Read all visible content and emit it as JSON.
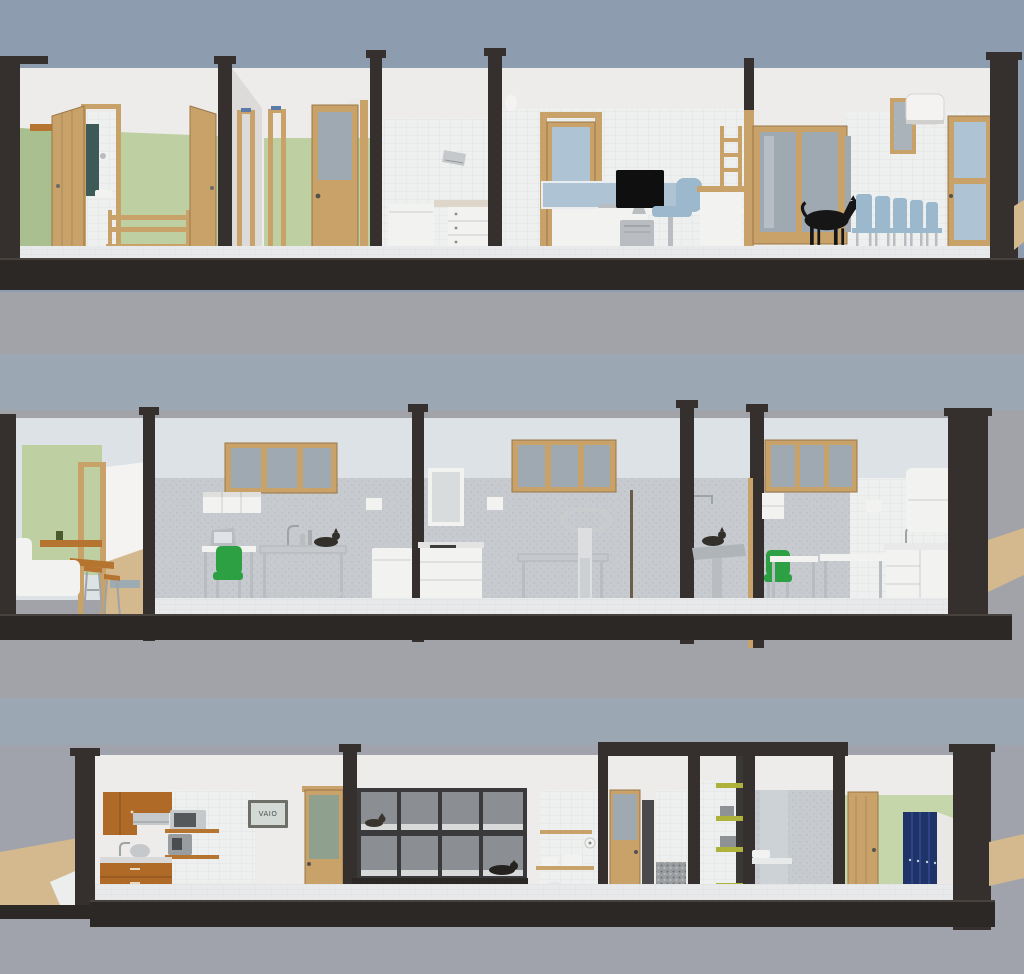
{
  "scene": {
    "type": "3d-architectural-section-render",
    "subject": "Veterinary clinic interior shown as three stacked cross-section strips",
    "sections": [
      {
        "name": "section-1-front",
        "rooms": [
          {
            "name": "entry-cloakroom",
            "objects": [
              "open-wood-door",
              "wall-hooks",
              "wc-toilet-paper",
              "wc-sink",
              "teal-panel",
              "coat-bench",
              "open-wood-door-2"
            ]
          },
          {
            "name": "corridor",
            "objects": [
              "wood-door-frames",
              "door-signs",
              "glazed-wood-door"
            ]
          },
          {
            "name": "utility-room",
            "objects": [
              "paper-towel-dispenser",
              "white-appliance",
              "counter-with-drawers"
            ]
          },
          {
            "name": "reception-office",
            "objects": [
              "wall-lamp",
              "glazed-wood-door",
              "reception-desk",
              "glass-screen",
              "monitor",
              "keyboard",
              "pc-tower",
              "office-chair",
              "service-counter",
              "telephone"
            ]
          },
          {
            "name": "waiting-room",
            "objects": [
              "wall-ladder-shelf",
              "glazed-double-door",
              "black-dog",
              "waiting-chairs-x5",
              "window-niche",
              "air-conditioner",
              "glazed-door"
            ]
          }
        ]
      },
      {
        "name": "section-2-middle",
        "rooms": [
          {
            "name": "break-room",
            "objects": [
              "green-wall",
              "wall-table",
              "wall-table-2",
              "white-sofa",
              "bar-stools",
              "doorway-to-corridor"
            ]
          },
          {
            "name": "laboratory",
            "objects": [
              "window",
              "wall-cabinet",
              "laptop",
              "desk",
              "green-chair",
              "stainless-table",
              "cat-on-table",
              "faucet",
              "fridge",
              "towel-dispenser"
            ]
          },
          {
            "name": "treatment-room",
            "objects": [
              "mirror-cabinet",
              "sink-counter",
              "towel-dispenser",
              "window",
              "stainless-table",
              "patient-lift"
            ]
          },
          {
            "name": "grooming-room",
            "objects": [
              "shower-arm",
              "wash-table",
              "cat"
            ]
          },
          {
            "name": "exam-room",
            "objects": [
              "window",
              "wall-shelf",
              "green-chair",
              "desk",
              "exam-table",
              "sink-counter",
              "wall-cabinet",
              "towel-holder"
            ]
          }
        ]
      },
      {
        "name": "section-3-back",
        "rooms": [
          {
            "name": "staff-kitchen",
            "objects": [
              "orange-upper-cabinet",
              "range-hood",
              "microwave",
              "wood-shelf",
              "coffee-machine",
              "sink",
              "kettle",
              "orange-base-cabinet",
              "wall-tv",
              "glazed-wood-door"
            ]
          },
          {
            "name": "kennel-room",
            "objects": [
              "kennel-cages-2x4",
              "cat-in-cage",
              "dog-in-cage",
              "wall-shelves",
              "small-sink",
              "toilet-paper-roll",
              "waste-bin",
              "glazed-door"
            ]
          },
          {
            "name": "shower-room",
            "objects": [
              "glazed-wood-door",
              "speckled-half-wall"
            ]
          },
          {
            "name": "shelf-corridor",
            "objects": [
              "green-shelves-x4",
              "storage-boxes"
            ]
          },
          {
            "name": "toilet-room",
            "objects": [
              "small-sink",
              "wall-hung-toilet"
            ]
          },
          {
            "name": "locker-room",
            "objects": [
              "wood-door",
              "shoe-bench",
              "blue-lockers-x4",
              "green-wall"
            ]
          }
        ]
      }
    ]
  },
  "labels": {
    "screen_brand": "VAIO"
  },
  "palette": {
    "sky": "#8d9cae",
    "bgGray": "#a2a3a9",
    "bgBlue": "#9ba7b3",
    "bgBottom": "#a0a3ab",
    "slab": "#2b2826",
    "cut": "#35302d",
    "wallWhite": "#edecea",
    "wallLit": "#f4f3f1",
    "wallShade": "#dcdbd9",
    "wallBlue": "#dde2e6",
    "tile": "#eef0f0",
    "lowerGray": "#c7cbcf",
    "green": "#bed0a2",
    "greenDark": "#aabf90",
    "green2": "#c5d6ab",
    "wood": "#c8a269",
    "woodDark": "#9a7747",
    "shelfWood": "#b5742f",
    "cabinetOrange": "#b06a28",
    "glass": "#9fa9b2",
    "glassBlue": "#aec4d4",
    "steel": "#c6c9cc",
    "silver": "#b9bcc0",
    "chairBlue": "#9cb8cd",
    "chairGreen": "#2da044",
    "furnWhite": "#f2f2f1",
    "darkObject": "#1a1a1a",
    "tealDoor": "#3d5a57",
    "lockerBlue": "#1e3368",
    "floorTile": "#e8e9ea",
    "floorWood": "#d4b88e",
    "kennelFrame": "#3a3a3c",
    "kennelCell": "#8b8e92",
    "oliveShelf": "#aeb23a"
  }
}
